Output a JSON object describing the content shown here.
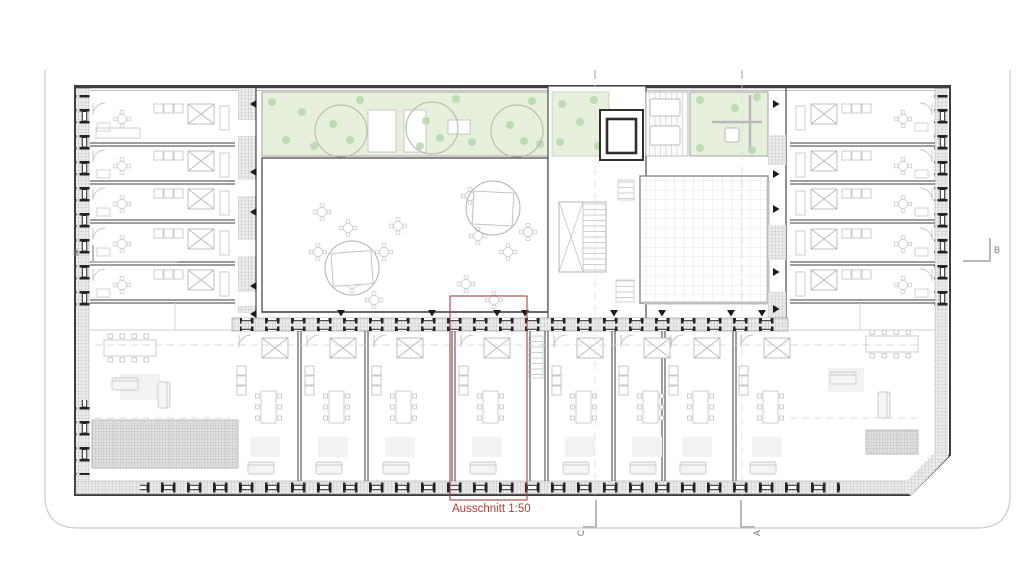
{
  "plan": {
    "detail_annotation": {
      "label": "Ausschnitt 1:50",
      "scale": "1:50"
    },
    "section_markers": {
      "left": "B",
      "right": "B",
      "bottom_first": "C",
      "bottom_second": "A"
    },
    "colors": {
      "annotation_red": "#a8423c",
      "garden_green": "#e6f0dc",
      "shrub_green": "#b7d7ab",
      "tree_outline": "#b2b3a8",
      "dark_wall": "#3e3e3e",
      "mid_wall": "#8a8a8a",
      "furniture_grey": "#c9c9c9",
      "boundary_grey": "#cbcbcb"
    }
  }
}
